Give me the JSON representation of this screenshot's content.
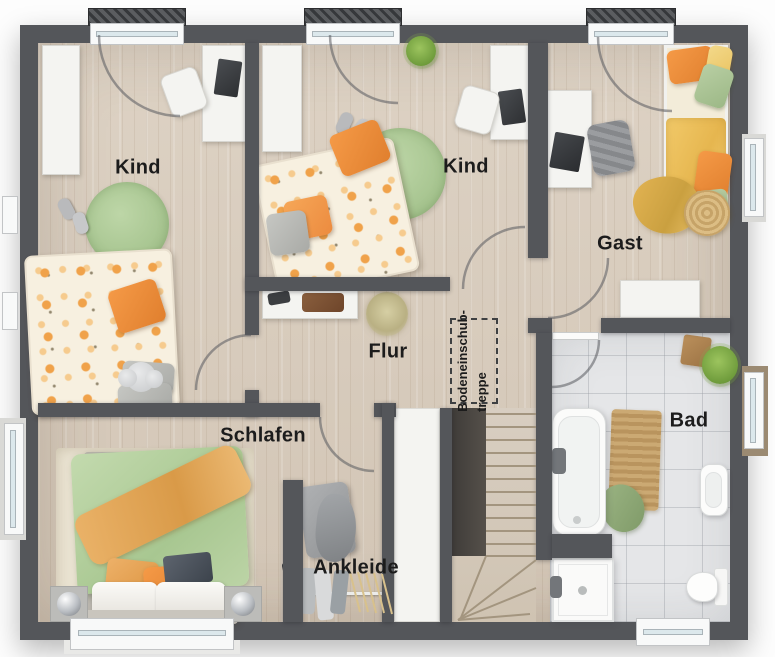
{
  "floorplan": {
    "rooms": [
      {
        "name": "Kind"
      },
      {
        "name": "Kind"
      },
      {
        "name": "Gast"
      },
      {
        "name": "Flur"
      },
      {
        "name": "Schlafen"
      },
      {
        "name": "Ankleide"
      },
      {
        "name": "Bad"
      }
    ],
    "attic_hatch": {
      "line1": "Bodeneinschub-",
      "line2": "treppe"
    },
    "colors": {
      "wall": "#54565A",
      "floor_wood": "#D7CBBC",
      "floor_tile": "#E5E6E8",
      "accent_orange": "#EC8B3F",
      "accent_green": "#AFCD9B",
      "accent_yellow": "#EFC461",
      "duvet_green": "#B7D2A2",
      "white_furniture": "#F4F4F1",
      "label_text": "#1C1C1C"
    }
  }
}
